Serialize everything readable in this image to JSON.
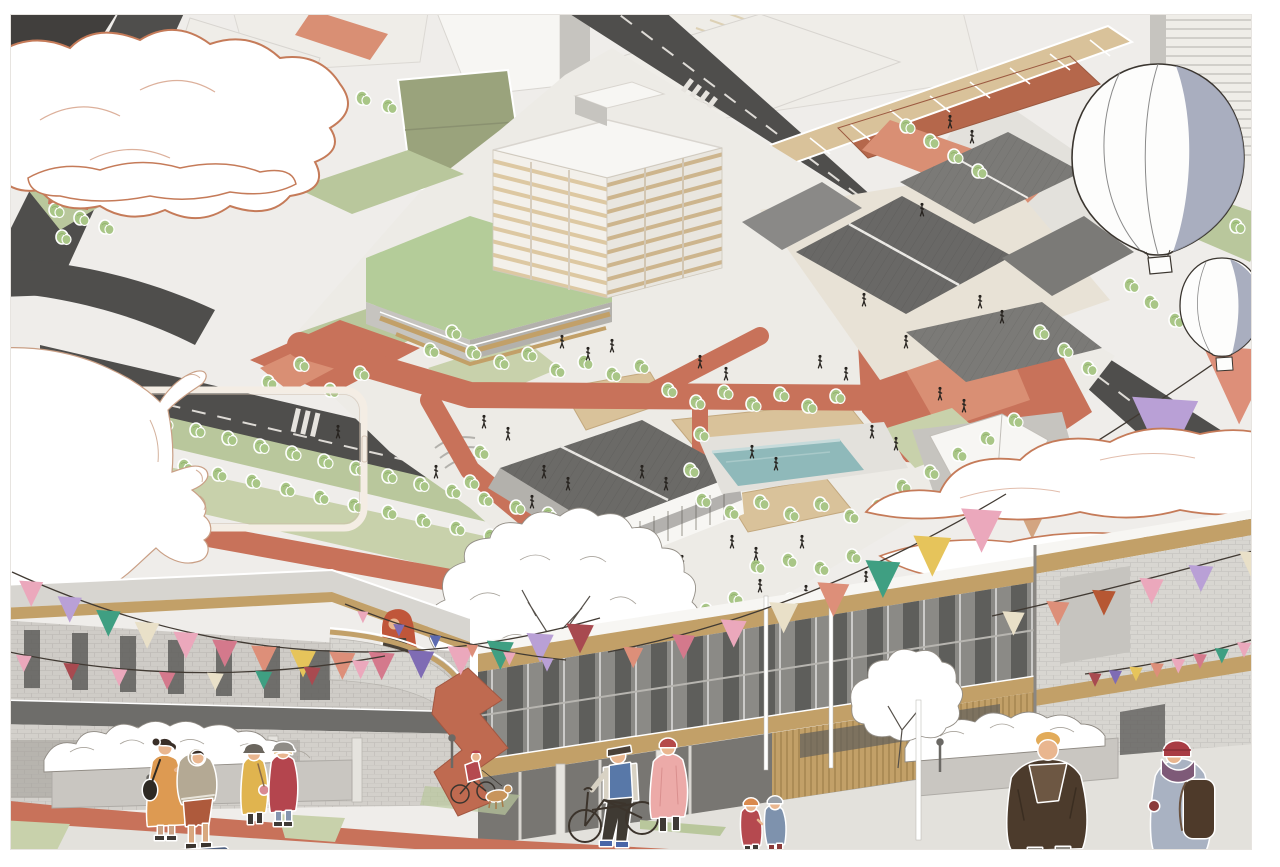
{
  "meta": {
    "kind": "architectural-masterplan-illustration",
    "views": [
      "aerial-axonometric-masterplan",
      "street-level-perspective"
    ]
  },
  "palette": {
    "paper": "#ffffff",
    "ground": "#efedea",
    "ground2": "#e3e1dc",
    "plate": "#edebe6",
    "road": "#4f4e4c",
    "roadDark": "#413f3d",
    "roadLine": "#dedbd6",
    "lawn": "#c8d1ab",
    "lawn2": "#b9c79c",
    "field": "#9aa37c",
    "tree": "#a9c687",
    "terra": "#c8725a",
    "terra2": "#d98f74",
    "walkred": "#b5674b",
    "sand": "#d9c29a",
    "wood": "#c2a068",
    "wood2": "#a8854e",
    "pool": "#8fb9ba",
    "poolEdge": "#c6dbdb",
    "roof": "#7b7a77",
    "roofDk": "#696866",
    "white": "#f7f6f3",
    "offwhite": "#efede8",
    "conc": "#c6c4bf",
    "conc2": "#b3b1ac",
    "brick": "#d8d6d1",
    "glass": "#8b8a86",
    "glassDk": "#5f5e5b",
    "cloudline": "#c57b59",
    "slate": "#9aa0b4",
    "ink": "#3a352f",
    "skin": "#e9b68f",
    "orangeDress": "#dd9a52",
    "hoodie": "#b4a994",
    "rustShorts": "#ae5a3c",
    "yellowCoat": "#e0b44f",
    "redCoat": "#b4454e",
    "pinkCoat": "#ecaaa8",
    "navyVest": "#5878a8",
    "brownCoat": "#4c3b2c",
    "brownCoat2": "#6d5743",
    "slateCoat": "#a9b2c2",
    "beanie": "#a83c44",
    "redHair": "#c0563a",
    "blond": "#e2ab59",
    "denim": "#8494af",
    "bagBrown": "#4e3a2a",
    "sculpture": "#bf6a50"
  },
  "artwork": {
    "flag_palette": {
      "pink": "#eba8bc",
      "rose": "#d4798c",
      "winered": "#a84a50",
      "salmon": "#dd8f79",
      "cream": "#e9e0c8",
      "tan": "#d3a581",
      "teal": "#3f9f82",
      "yellow": "#e6c45b",
      "lavender": "#b9a0d6",
      "purple": "#7f6cb4",
      "blue": "#5c6ab0",
      "rust": "#b65733"
    },
    "bunting_strings": [
      {
        "name": "left-upper",
        "layer": "front",
        "p0": [
          12,
          572
        ],
        "pc": [
          300,
          704
        ],
        "p1": [
          600,
          618
        ],
        "s": [
          26,
          30
        ],
        "colors": [
          "pink",
          "lavender",
          "teal",
          "cream",
          "pink",
          "rose",
          "salmon",
          "yellow",
          "salmon",
          "rose",
          "purple",
          "pink",
          "teal",
          "lavender",
          "winered"
        ]
      },
      {
        "name": "left-lower",
        "layer": "front",
        "p0": [
          0,
          650
        ],
        "pc": [
          190,
          692
        ],
        "p1": [
          385,
          656
        ],
        "s": [
          17,
          19
        ],
        "colors": [
          "pink",
          "winered",
          "pink",
          "rose",
          "cream",
          "teal",
          "winered",
          "pink"
        ]
      },
      {
        "name": "center-rise",
        "layer": "front",
        "p0": [
          608,
          652
        ],
        "pc": [
          810,
          612
        ],
        "p1": [
          1006,
          494
        ],
        "s": [
          20,
          46
        ],
        "colors": [
          "salmon",
          "rose",
          "pink",
          "cream",
          "salmon",
          "teal",
          "yellow",
          "pink"
        ]
      },
      {
        "name": "right-giant",
        "layer": "back",
        "p0": [
          1002,
          498
        ],
        "pc": [
          1120,
          432
        ],
        "p1": [
          1278,
          318
        ],
        "s": [
          55,
          82
        ],
        "colors": [
          "tan",
          "pink",
          "lavender",
          "salmon"
        ]
      },
      {
        "name": "right-wall-upper",
        "layer": "front",
        "p0": [
          992,
          616
        ],
        "pc": [
          1120,
          588
        ],
        "p1": [
          1278,
          544
        ],
        "s": [
          24,
          28
        ],
        "colors": [
          "cream",
          "salmon",
          "rust",
          "pink",
          "lavender",
          "cream"
        ]
      },
      {
        "name": "right-wall-lower",
        "layer": "front",
        "p0": [
          1085,
          674
        ],
        "pc": [
          1175,
          664
        ],
        "p1": [
          1278,
          632
        ],
        "s": [
          14,
          16
        ],
        "colors": [
          "winered",
          "purple",
          "yellow",
          "salmon",
          "pink",
          "rose",
          "teal",
          "pink",
          "cream"
        ]
      },
      {
        "name": "balcony",
        "layer": "front",
        "p0": [
          345,
          604
        ],
        "pc": [
          452,
          648
        ],
        "p1": [
          566,
          660
        ],
        "s": [
          12,
          14
        ],
        "colors": [
          "pink",
          "purple",
          "blue",
          "salmon",
          "pink",
          "lavender"
        ]
      }
    ],
    "aerial_trees": [
      [
        100,
        408
      ],
      [
        132,
        415
      ],
      [
        164,
        423
      ],
      [
        196,
        430
      ],
      [
        228,
        438
      ],
      [
        260,
        446
      ],
      [
        292,
        453
      ],
      [
        324,
        461
      ],
      [
        356,
        468
      ],
      [
        388,
        476
      ],
      [
        420,
        484
      ],
      [
        452,
        491
      ],
      [
        484,
        499
      ],
      [
        516,
        507
      ],
      [
        548,
        514
      ],
      [
        580,
        522
      ],
      [
        150,
        458
      ],
      [
        184,
        466
      ],
      [
        218,
        474
      ],
      [
        252,
        481
      ],
      [
        286,
        489
      ],
      [
        320,
        497
      ],
      [
        354,
        505
      ],
      [
        388,
        512
      ],
      [
        422,
        520
      ],
      [
        456,
        528
      ],
      [
        490,
        536
      ],
      [
        524,
        543
      ],
      [
        558,
        551
      ],
      [
        592,
        559
      ],
      [
        268,
        382
      ],
      [
        300,
        364
      ],
      [
        330,
        390
      ],
      [
        360,
        373
      ],
      [
        55,
        210
      ],
      [
        80,
        218
      ],
      [
        105,
        227
      ],
      [
        62,
        237
      ],
      [
        25,
        142
      ],
      [
        48,
        152
      ],
      [
        310,
        82
      ],
      [
        336,
        90
      ],
      [
        362,
        98
      ],
      [
        388,
        106
      ],
      [
        906,
        126
      ],
      [
        930,
        141
      ],
      [
        954,
        156
      ],
      [
        978,
        171
      ],
      [
        1212,
        212
      ],
      [
        1236,
        226
      ],
      [
        1258,
        240
      ],
      [
        1150,
        302
      ],
      [
        1175,
        320
      ],
      [
        1200,
        338
      ],
      [
        1225,
        356
      ],
      [
        1250,
        374
      ],
      [
        1130,
        285
      ],
      [
        1040,
        332
      ],
      [
        1064,
        350
      ],
      [
        1088,
        368
      ],
      [
        472,
        352
      ],
      [
        500,
        362
      ],
      [
        528,
        354
      ],
      [
        556,
        370
      ],
      [
        584,
        362
      ],
      [
        612,
        374
      ],
      [
        640,
        366
      ],
      [
        668,
        390
      ],
      [
        696,
        402
      ],
      [
        724,
        392
      ],
      [
        752,
        404
      ],
      [
        780,
        394
      ],
      [
        808,
        406
      ],
      [
        836,
        396
      ],
      [
        700,
        434
      ],
      [
        690,
        470
      ],
      [
        702,
        500
      ],
      [
        730,
        512
      ],
      [
        760,
        502
      ],
      [
        790,
        514
      ],
      [
        820,
        504
      ],
      [
        850,
        516
      ],
      [
        878,
        506
      ],
      [
        622,
        592
      ],
      [
        650,
        606
      ],
      [
        678,
        594
      ],
      [
        706,
        610
      ],
      [
        734,
        598
      ],
      [
        762,
        612
      ],
      [
        790,
        600
      ],
      [
        818,
        614
      ],
      [
        846,
        602
      ],
      [
        872,
        618
      ],
      [
        756,
        566
      ],
      [
        788,
        560
      ],
      [
        820,
        568
      ],
      [
        852,
        556
      ],
      [
        930,
        472
      ],
      [
        958,
        454
      ],
      [
        986,
        438
      ],
      [
        1014,
        420
      ],
      [
        902,
        486
      ],
      [
        480,
        452
      ],
      [
        470,
        482
      ],
      [
        590,
        574
      ],
      [
        452,
        332
      ],
      [
        430,
        350
      ]
    ],
    "aerial_people": [
      [
        250,
        72
      ],
      [
        272,
        86
      ],
      [
        292,
        101
      ],
      [
        338,
        432
      ],
      [
        436,
        472
      ],
      [
        532,
        502
      ],
      [
        562,
        342
      ],
      [
        588,
        354
      ],
      [
        612,
        346
      ],
      [
        700,
        362
      ],
      [
        726,
        374
      ],
      [
        820,
        362
      ],
      [
        846,
        374
      ],
      [
        940,
        394
      ],
      [
        964,
        406
      ],
      [
        872,
        432
      ],
      [
        896,
        444
      ],
      [
        752,
        452
      ],
      [
        776,
        464
      ],
      [
        642,
        472
      ],
      [
        666,
        484
      ],
      [
        544,
        472
      ],
      [
        568,
        484
      ],
      [
        484,
        422
      ],
      [
        508,
        434
      ],
      [
        980,
        302
      ],
      [
        1002,
        317
      ],
      [
        732,
        542
      ],
      [
        756,
        554
      ],
      [
        802,
        542
      ],
      [
        682,
        562
      ],
      [
        624,
        542
      ],
      [
        906,
        342
      ],
      [
        864,
        300
      ],
      [
        922,
        210
      ],
      [
        950,
        122
      ],
      [
        972,
        137
      ],
      [
        760,
        586
      ],
      [
        806,
        592
      ],
      [
        866,
        578
      ]
    ]
  }
}
